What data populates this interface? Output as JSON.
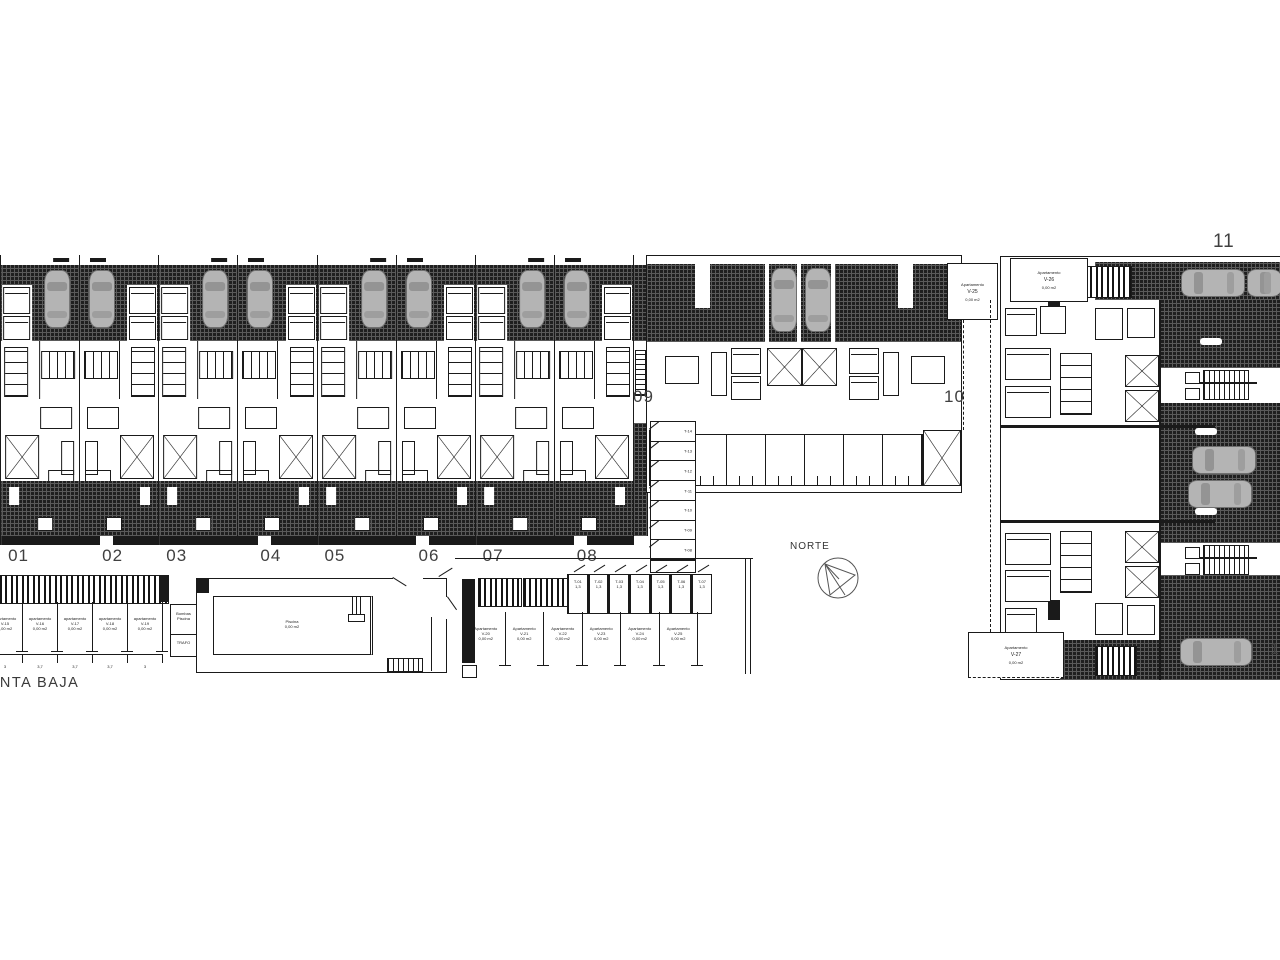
{
  "floor_label": "PLANTA BAJA",
  "compass_label": "NORTE",
  "townhouses": {
    "numbers": [
      "01",
      "02",
      "03",
      "04",
      "05",
      "06",
      "07",
      "08"
    ]
  },
  "duplex": {
    "left_number": "09",
    "right_number": "10"
  },
  "building11": {
    "number": "11",
    "cut_label": "1",
    "boxes": {
      "v25": {
        "title": "Apartamento",
        "code": "V-25",
        "area": "0,00 m2"
      },
      "v26": {
        "title": "Apartamento",
        "code": "V-26",
        "area": "0,00 m2"
      },
      "v27": {
        "title": "Apartamento",
        "code": "V-27",
        "area": "0,00 m2"
      }
    }
  },
  "parking_left": {
    "stalls": [
      {
        "title": "apartamento",
        "code": "V-15",
        "area": "0,00 m2"
      },
      {
        "title": "apartamento",
        "code": "V-16",
        "area": "0,00 m2"
      },
      {
        "title": "apartamento",
        "code": "V-17",
        "area": "0,00 m2"
      },
      {
        "title": "apartamento",
        "code": "V-18",
        "area": "0,00 m2"
      },
      {
        "title": "apartamento",
        "code": "V-19",
        "area": "0,00 m2"
      }
    ],
    "dims": [
      "3",
      "3,7",
      "3,7",
      "3,7",
      "3"
    ]
  },
  "parking_center": {
    "trasteros": [
      {
        "code": "T-01",
        "size": "1,3"
      },
      {
        "code": "T-02",
        "size": "1,3"
      },
      {
        "code": "T-03",
        "size": "1,3"
      },
      {
        "code": "T-04",
        "size": "1,3"
      },
      {
        "code": "T-05",
        "size": "1,3"
      },
      {
        "code": "T-06",
        "size": "1,3"
      },
      {
        "code": "T-07",
        "size": "1,3"
      }
    ],
    "stalls": [
      {
        "title": "Apartamento",
        "code": "V-20",
        "area": "0,00 m2"
      },
      {
        "title": "Apartamento",
        "code": "V-21",
        "area": "0,00 m2"
      },
      {
        "title": "Apartamento",
        "code": "V-22",
        "area": "0,00 m2"
      },
      {
        "title": "Apartamento",
        "code": "V-23",
        "area": "0,00 m2"
      },
      {
        "title": "Apartamento",
        "code": "V-24",
        "area": "0,00 m2"
      },
      {
        "title": "Apartamento",
        "code": "V-25",
        "area": "0,00 m2"
      }
    ]
  },
  "trastero_column": [
    {
      "code": "T-14"
    },
    {
      "code": "T-13"
    },
    {
      "code": "T-12"
    },
    {
      "code": "T-11"
    },
    {
      "code": "T-10"
    },
    {
      "code": "T-09"
    },
    {
      "code": "T-08"
    }
  ],
  "pool": {
    "name": "Piscina",
    "area": "0,00 m2"
  },
  "rooms": {
    "pump_line1": "Bombas",
    "pump_line2": "Piscina",
    "trafo": "TRAFO"
  }
}
